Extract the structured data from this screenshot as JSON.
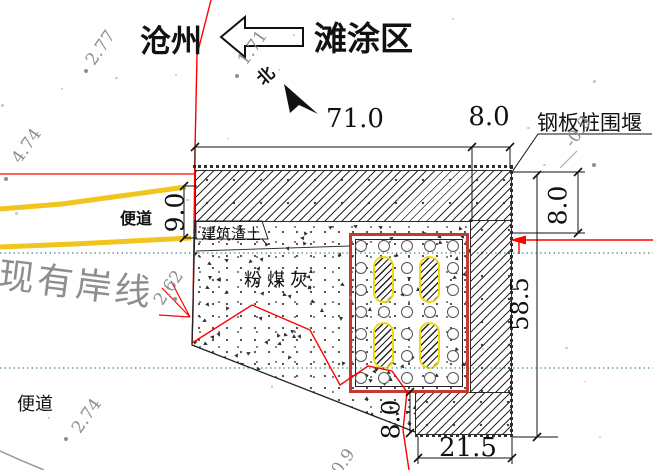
{
  "header": {
    "city": "沧州",
    "area": "滩涂区",
    "north": "北"
  },
  "labels": {
    "sheet_pile_cofferdam": "钢板桩围堰",
    "access_road_top": "便道",
    "access_road_bottom": "便道",
    "construction_debris": "建筑渣土",
    "fly_ash": "粉煤灰",
    "existing_shoreline": "现有岸线"
  },
  "dimensions": {
    "top_width": "71.0",
    "wall_width_top": "8.0",
    "wall_height_right": "8.0",
    "road_opening_left": "9.0",
    "right_side_length": "58.5",
    "foot_height": "8.0",
    "foot_width": "21.5"
  },
  "elevations": [
    "2.77",
    "4.74",
    "1.71",
    "-0.9",
    "2.62",
    "2.74",
    "0.9"
  ],
  "pile_cage": {
    "rows": 7,
    "cols": 5,
    "stadium_openings": 4
  },
  "colors": {
    "line_red": "#ff0000",
    "road_yellow": "#f2c41e",
    "waterline_teal": "#1d6e6e",
    "cage_red": "#c23b32",
    "stadium_yellow": "#f0da0a",
    "annotation_gray": "#8f8f8f"
  }
}
